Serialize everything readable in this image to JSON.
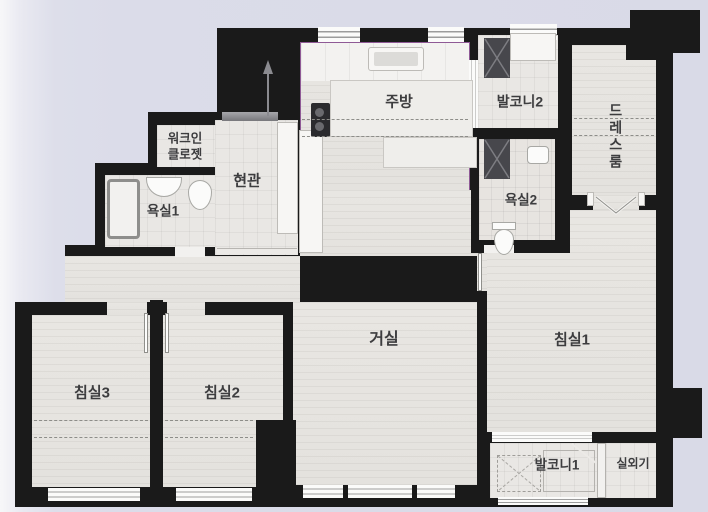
{
  "plan_title": "apartment-floor-plan",
  "rooms": {
    "kitchen": {
      "label": "주방"
    },
    "balcony2": {
      "label": "발코니2"
    },
    "dressroom": {
      "label": "드레스룸"
    },
    "walkin_closet": {
      "label": "워크인\n클로젯"
    },
    "entrance": {
      "label": "현관"
    },
    "bathroom1": {
      "label": "욕실1"
    },
    "bathroom2": {
      "label": "욕실2"
    },
    "living": {
      "label": "거실"
    },
    "bedroom1": {
      "label": "침실1"
    },
    "bedroom2": {
      "label": "침실2"
    },
    "bedroom3": {
      "label": "침실3"
    },
    "balcony1": {
      "label": "발코니1"
    },
    "outdoor_unit": {
      "label": "실외기"
    }
  },
  "colors": {
    "wall": "#1a1a1a",
    "floor_wood": "#e6e4e1",
    "floor_tile": "#e9e7e4",
    "kitchen_accent": "#8f5a96",
    "background": "#dcdde9",
    "duct": "#47474c"
  }
}
